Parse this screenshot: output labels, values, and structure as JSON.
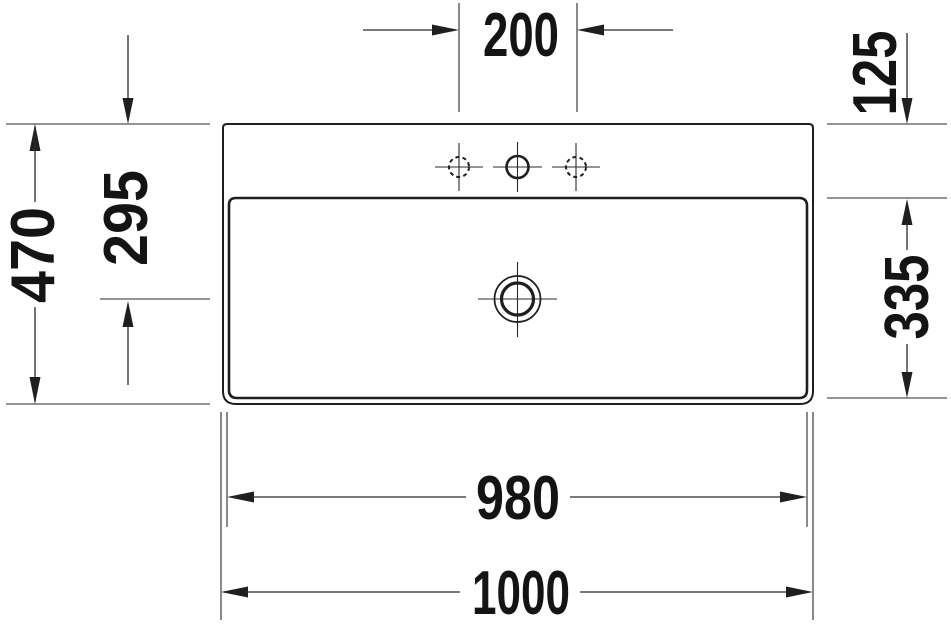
{
  "drawing": {
    "name": "Washbasin top view - dimensioned technical drawing",
    "colors": {
      "background": "#ffffff",
      "line": "#1f1f1f"
    },
    "labels": {
      "faucet_hole_spacing": "200",
      "back_ledge_depth": "125",
      "overall_depth": "470",
      "drain_offset_from_back": "295",
      "bowl_depth": "335",
      "bowl_width": "980",
      "overall_width": "1000"
    }
  }
}
